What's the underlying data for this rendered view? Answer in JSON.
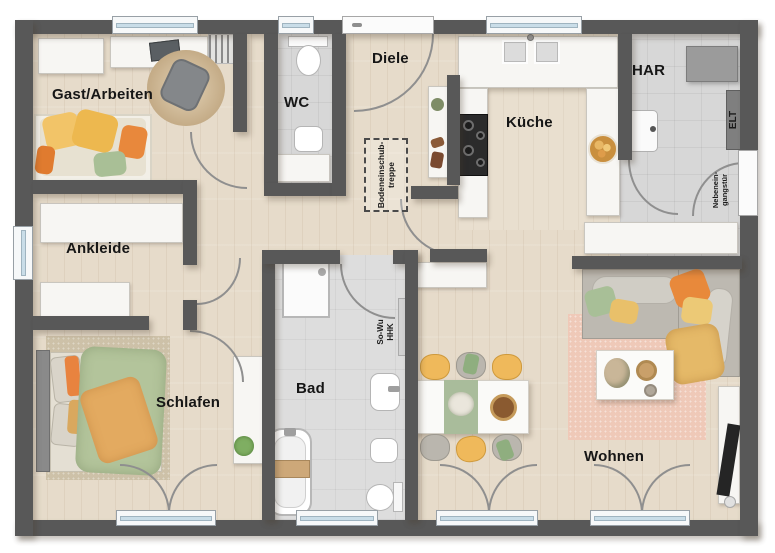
{
  "plan_title": "Bungalow Grundriss",
  "rooms": {
    "gast_arbeiten": "Gast/Arbeiten",
    "wc": "WC",
    "diele": "Diele",
    "kueche": "Küche",
    "har": "HAR",
    "ankleide": "Ankleide",
    "schlafen": "Schlafen",
    "bad": "Bad",
    "wohnen": "Wohnen"
  },
  "annotations": {
    "attic_stairs_line1": "Bodeneinschub-",
    "attic_stairs_line2": "treppe",
    "elt": "ELT",
    "side_door_line1": "Nebenein-",
    "side_door_line2": "gangstür",
    "heating_line1": "So-Wu",
    "heating_line2": "HHK"
  },
  "colors": {
    "wall": "#585858",
    "wood_floor": "#e6dbca",
    "tile_floor": "#d7d7d7",
    "window_glass": "#c9dde8",
    "accent_yellow": "#efb95b",
    "accent_orange": "#e8883c",
    "accent_green": "#a9bf96",
    "rug_pink": "#efc9b8",
    "rug_beige": "#c9b28f"
  }
}
